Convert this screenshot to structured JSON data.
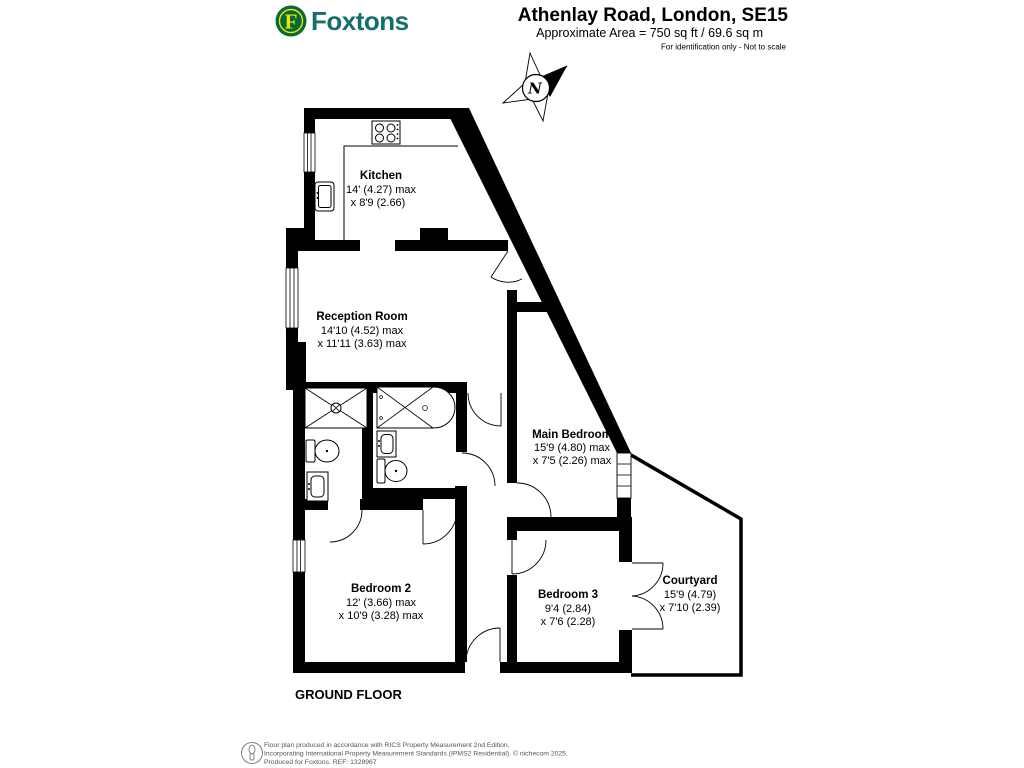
{
  "header": {
    "brand": "Foxtons",
    "brand_initial": "F",
    "title": "Athenlay Road, London, SE15",
    "area": "Approximate Area = 750 sq ft / 69.6 sq m",
    "disclaimer": "For identification only - Not to scale"
  },
  "compass": {
    "north_label": "N"
  },
  "floor_label": "GROUND FLOOR",
  "rooms": [
    {
      "name": "Kitchen",
      "dim1": "14' (4.27) max",
      "dim2": "x 8'9 (2.66)"
    },
    {
      "name": "Reception Room",
      "dim1": "14'10 (4.52) max",
      "dim2": "x 11'11 (3.63) max"
    },
    {
      "name": "Main Bedroom",
      "dim1": "15'9 (4.80) max",
      "dim2": "x 7'5 (2.26) max"
    },
    {
      "name": "Bedroom 2",
      "dim1": "12' (3.66) max",
      "dim2": "x 10'9 (3.28) max"
    },
    {
      "name": "Bedroom 3",
      "dim1": "9'4 (2.84)",
      "dim2": "x 7'6 (2.28)"
    },
    {
      "name": "Courtyard",
      "dim1": "15'9 (4.79)",
      "dim2": "x 7'10 (2.39)"
    }
  ],
  "footer": {
    "line1": "Floor plan produced in accordance with RICS Property Measurement 2nd Edition,",
    "line2": "Incorporating International Property Measurement Standards (IPMS2 Residential).   © nichecom 2025.",
    "line3": "Produced for Foxtons.   REF:  1328967"
  },
  "colors": {
    "wall": "#000000",
    "brand_green": "#046a38",
    "brand_yellow": "#f5e200",
    "brand_teal": "#136f6c",
    "footer_gray": "#555555"
  }
}
